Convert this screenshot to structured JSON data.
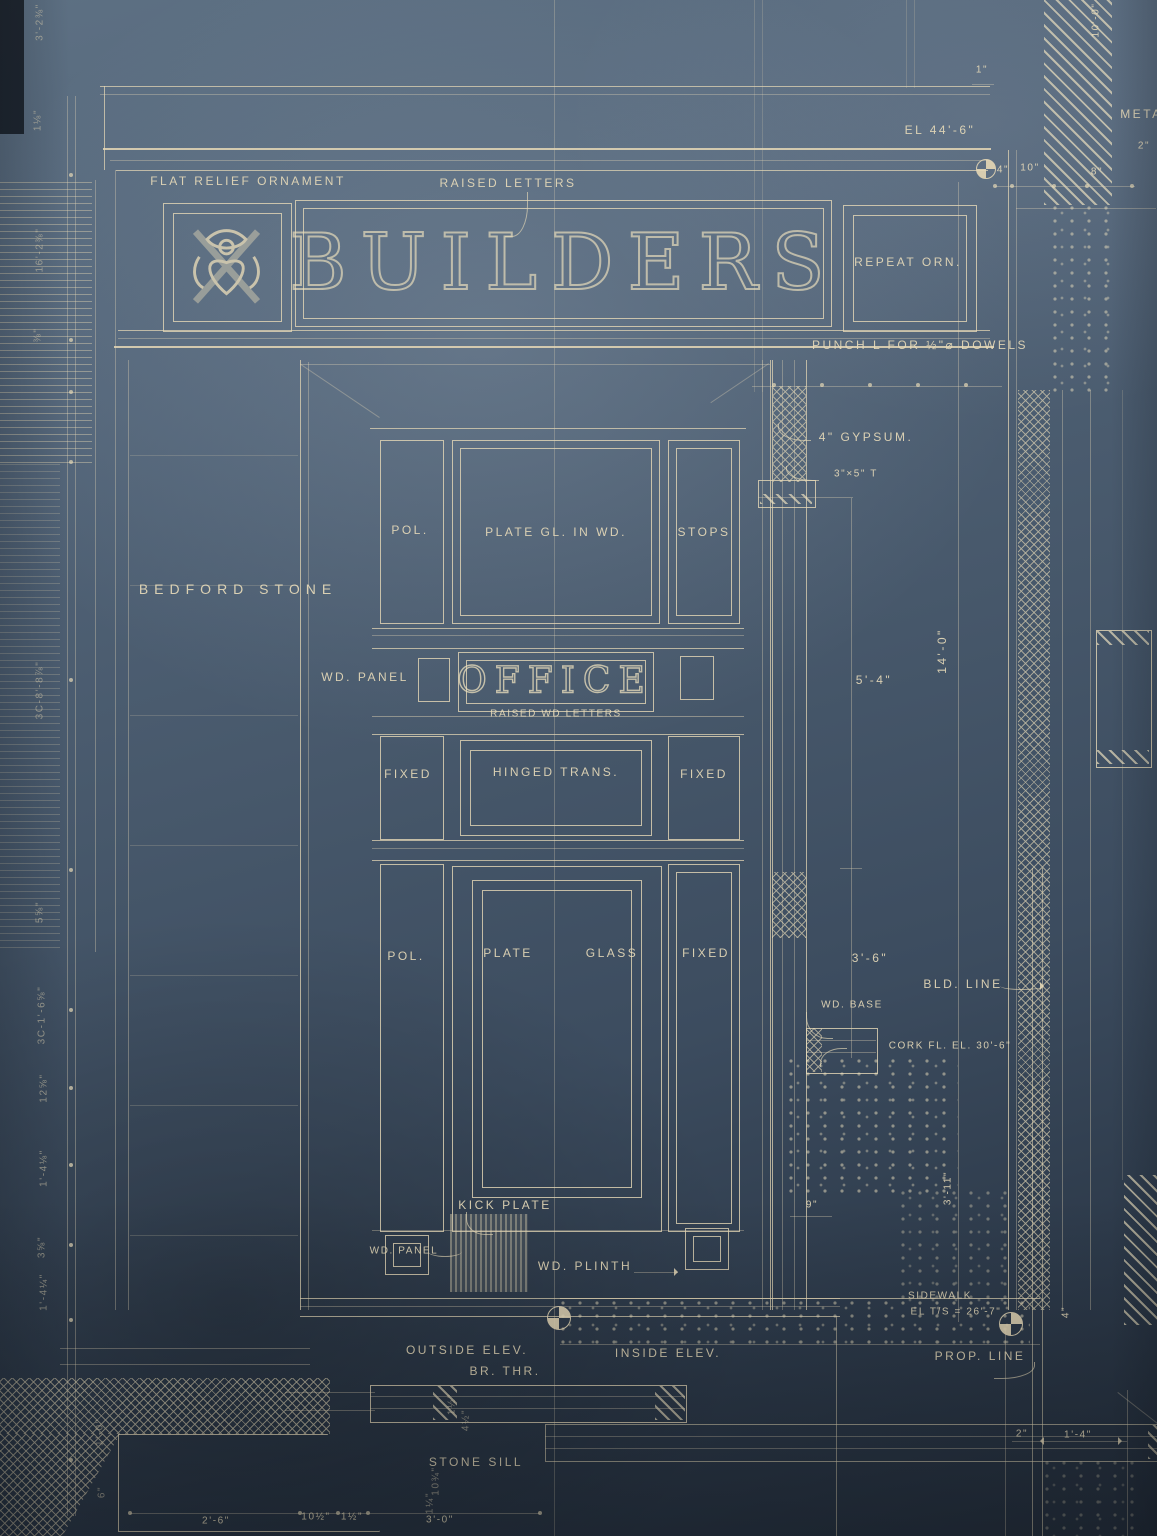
{
  "meta": {
    "drawing_type": "architectural blueprint, storefront entrance elevation and wall section"
  },
  "colors": {
    "paper_top": "#5d7083",
    "paper_mid": "#47586b",
    "paper_bottom": "#232d3a",
    "line": "#e6d8b6",
    "line_bright": "#f4e6c4",
    "text": "#e9dcba",
    "dark_corner": "#141a22"
  },
  "labels": {
    "header": {
      "flat_relief": "FLAT RELIEF ORNAMENT",
      "raised_letters": "RAISED  LETTERS",
      "el_44_6": "EL 44'-6\"",
      "builders": "BUILDERS",
      "repeat_orn": "REPEAT ORN.",
      "punch_note": "PUNCH  L  FOR  ½\"⌀ DOWELS",
      "metal": "METAL",
      "two_in": "2\"",
      "one_in": "1\"",
      "dim_4": "4\"",
      "dim_10": "10\"",
      "dim_8": "8\"",
      "ten_feet": "10'-0\""
    },
    "elevation": {
      "bedford": "BEDFORD  STONE",
      "pol_upper": "POL.",
      "plate_gl": "PLATE  GL.  IN  WD.",
      "stops": "STOPS",
      "wd_panel": "WD. PANEL",
      "office": "OFFICE",
      "raised_wd": "RAISED  WD  LETTERS",
      "fixed_l": "FIXED",
      "hinged": "HINGED  TRANS.",
      "fixed_r": "FIXED",
      "pol_lower": "POL.",
      "plate": "PLATE",
      "glass": "GLASS",
      "fixed_b": "FIXED",
      "kick": "KICK  PLATE",
      "wd_panel_b": "WD. PANEL",
      "wd_plinth": "WD. PLINTH"
    },
    "section": {
      "gypsum": "4\" GYPSUM.",
      "t3x5": "3\"×5\" T",
      "dim_5_4": "5'-4\"",
      "dim_14_0": "14'-0\"",
      "dim_3_6": "3'-6\"",
      "wd_base": "WD. BASE",
      "cork": "CORK FL.   EL. 30'-6\"",
      "bld_line": "BLD. LINE",
      "dim_9": "9\"",
      "dim_3_11": "3'-11\"",
      "sidewalk1": "SIDEWALK",
      "sidewalk2": "EL T/S = 26'-7\"",
      "prop_line": "PROP.  LINE",
      "dim_4_rot": "4\""
    },
    "footer": {
      "outside": "OUTSIDE  ELEV.",
      "br_thr": "BR. THR.",
      "inside": "INSIDE  ELEV.",
      "stone_sill": "STONE SILL",
      "d_2_6": "2'-6\"",
      "d_10h": "10½\"",
      "d_1h": "1½\"",
      "d_3_0": "3'-0\"",
      "d_2": "2\"",
      "d_1_4": "1'-4\"",
      "r_1h": "1½\"",
      "r_4h": "4½\"",
      "r_10q": "10¾\"",
      "r_1q": "1¼\"",
      "r_1_0": "1'-0\"",
      "r_6": "6\""
    },
    "left_margin": [
      "3'-2⅜\"",
      "1⅛\"",
      "16'-2⅜\"",
      "⅜\"",
      "3C-8'-8⅞\"",
      "5⅝\"",
      "3C-1'-6⅝\"",
      "12⅝\"",
      "1'-4⅛\"",
      "3⅝\"",
      "1'-4¼\""
    ]
  }
}
